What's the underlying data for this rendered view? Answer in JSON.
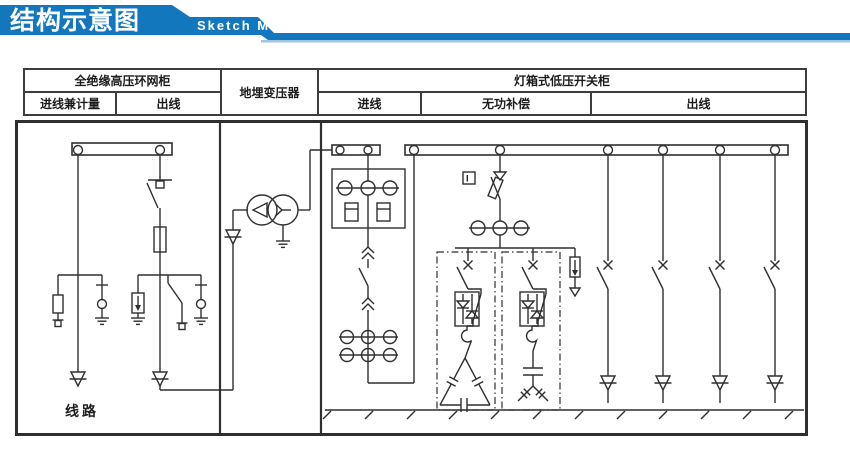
{
  "header": {
    "title_cn": "结构示意图",
    "title_en": "Sketch Map"
  },
  "colors": {
    "banner_blue": "#1377bd",
    "banner_light": "#9fc6e3",
    "ink": "#2f2f2f"
  },
  "table": {
    "hv_cabinet": "全绝缘高压环网柜",
    "hv_in": "进线兼计量",
    "hv_out": "出线",
    "transformer": "地埋变压器",
    "lv_cabinet": "灯箱式低压开关柜",
    "lv_in": "进线",
    "lv_comp": "无功补偿",
    "lv_out": "出线"
  },
  "diagram": {
    "line_label": "线路",
    "meter_label": "I"
  }
}
